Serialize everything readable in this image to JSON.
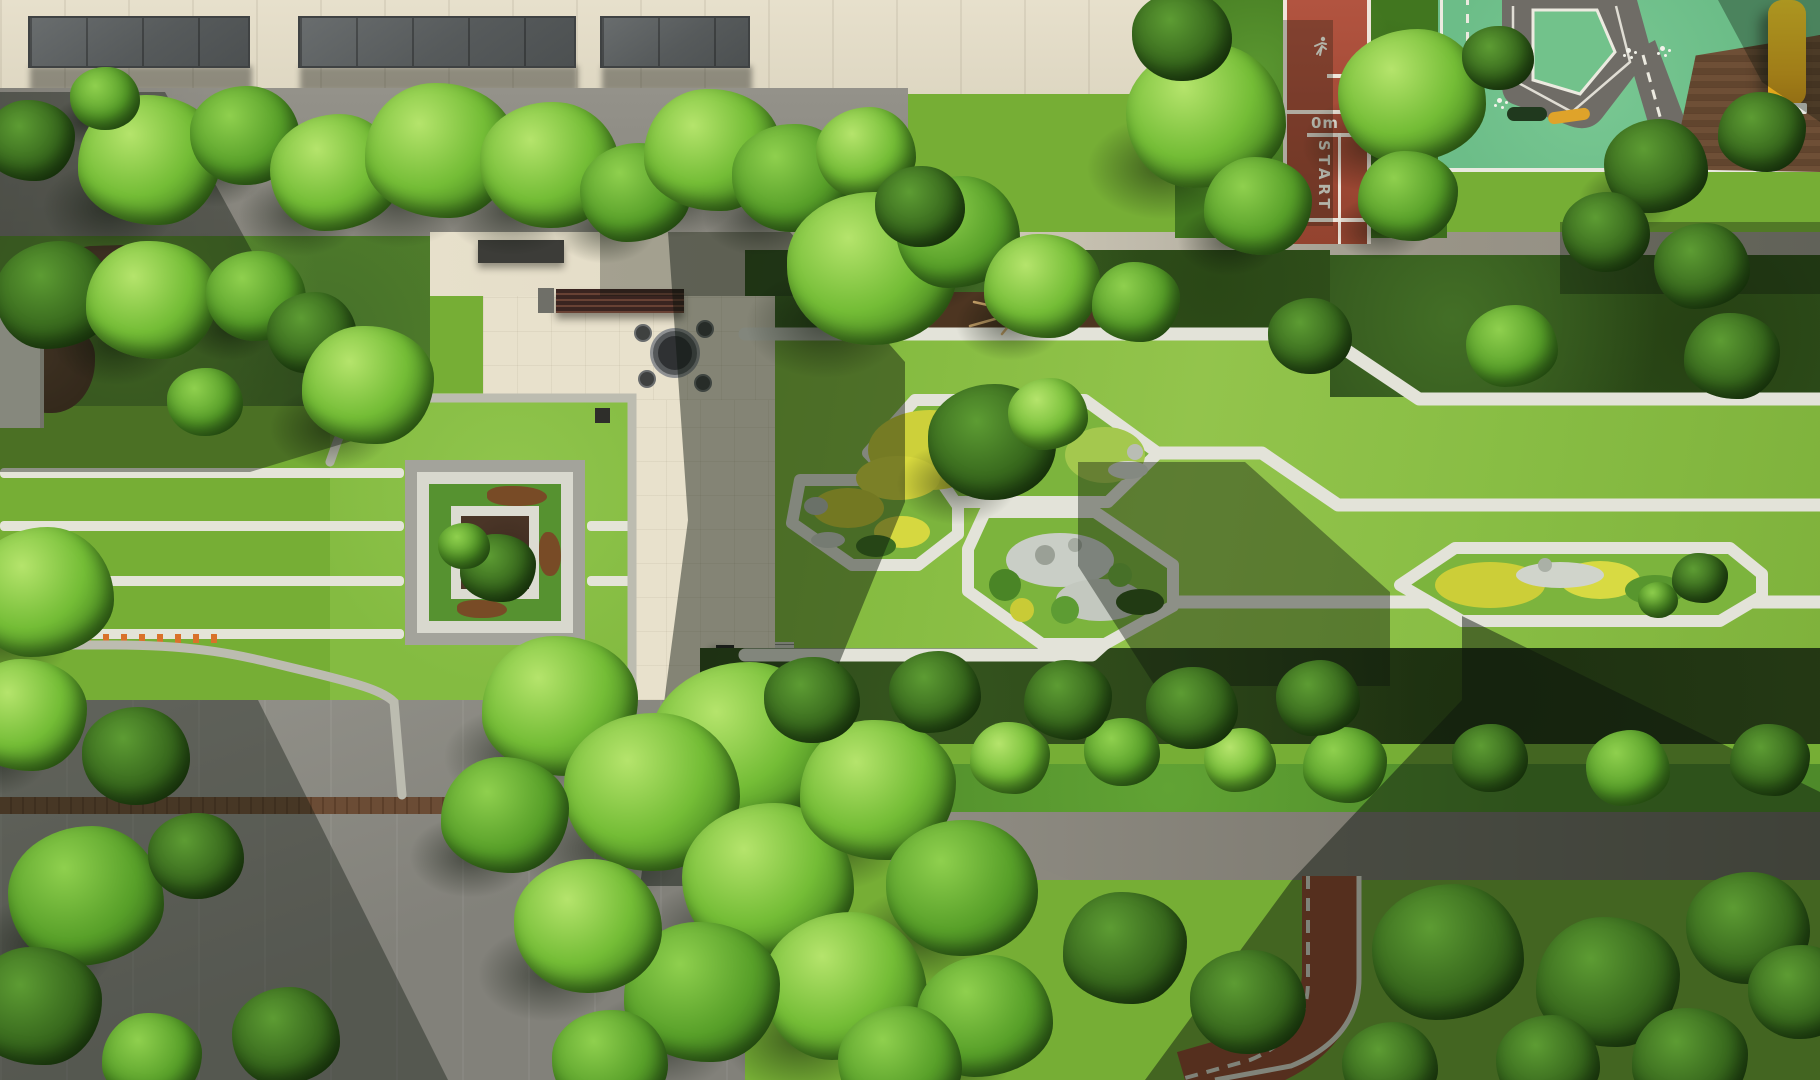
{
  "scene": {
    "description": "Aerial drone photo of a residential landscape: formal concentric garden, geometric lawn paths with planted islands, central plaza with round tables, red running track, children's traffic playground, tree masses and long building shadows.",
    "track": {
      "zero_label": "0m",
      "start_label": "START",
      "surface_color": "#a84b36",
      "line_color": "#f4f1e6"
    },
    "playground": {
      "surface_color": "#6cbd88",
      "road_color": "#6f6c66",
      "deck_color": "#6e4f36",
      "slide_color": "#ffd92b",
      "kid_car_color": "#20391e",
      "trailer_color": "#dfa32a"
    },
    "palette": {
      "lawn": "#7db63a",
      "lawn_bright": "#93c44c",
      "hedge_dark": "#2f4f1b",
      "tree_bright": "#74bd36",
      "tree_dark": "#38691d",
      "paving_cream": "#e7e0cb",
      "paving_gray": "#8f8d85",
      "curb_white": "#e3e3d9",
      "mulch_brown": "#4d3521",
      "yellow_shrub": "#cdd03a",
      "gravel_white": "#cdd1c8",
      "shadow": "#0c150c"
    },
    "icons": {
      "runner": "runner-pictogram-icon",
      "flower_marking": "pavement-flower-marking-icon"
    },
    "islands": [
      {
        "name": "island-a",
        "contents": "yellow shrubs, trees, gravel"
      },
      {
        "name": "island-b",
        "contents": "yellow shrubs, rock, gravel"
      },
      {
        "name": "island-c",
        "contents": "rock garden, gravel, green mounds"
      },
      {
        "name": "island-d",
        "contents": "yellow shrubs, gravel, small trees"
      }
    ],
    "furniture": [
      {
        "name": "round-table",
        "x": 675,
        "y": 353
      },
      {
        "name": "round-table",
        "x": 679,
        "y": 753
      }
    ],
    "trees": [
      [
        150,
        160,
        72,
        0,
        1
      ],
      [
        245,
        135,
        55,
        1,
        1
      ],
      [
        335,
        172,
        65,
        0,
        1
      ],
      [
        440,
        150,
        75,
        0,
        1
      ],
      [
        550,
        165,
        70,
        0,
        1
      ],
      [
        635,
        192,
        55,
        1,
        1
      ],
      [
        712,
        150,
        68,
        0,
        1
      ],
      [
        792,
        178,
        60,
        1,
        1
      ],
      [
        866,
        152,
        50,
        0,
        1
      ],
      [
        30,
        140,
        45,
        2,
        0
      ],
      [
        105,
        98,
        35,
        1,
        1
      ],
      [
        55,
        295,
        60,
        2,
        0
      ],
      [
        152,
        300,
        66,
        0,
        1
      ],
      [
        256,
        296,
        50,
        1,
        1
      ],
      [
        312,
        332,
        45,
        2,
        0
      ],
      [
        368,
        385,
        66,
        0,
        1
      ],
      [
        205,
        402,
        38,
        1,
        0
      ],
      [
        42,
        592,
        72,
        0,
        1
      ],
      [
        25,
        715,
        62,
        0,
        1
      ],
      [
        136,
        756,
        54,
        2,
        0
      ],
      [
        86,
        896,
        78,
        1,
        1
      ],
      [
        36,
        1006,
        66,
        2,
        0
      ],
      [
        196,
        856,
        48,
        2,
        0
      ],
      [
        286,
        1036,
        54,
        2,
        0
      ],
      [
        152,
        1058,
        50,
        1,
        0
      ],
      [
        872,
        268,
        85,
        0,
        1
      ],
      [
        958,
        232,
        62,
        1,
        1
      ],
      [
        1042,
        286,
        58,
        0,
        1
      ],
      [
        920,
        206,
        45,
        2,
        0
      ],
      [
        1206,
        116,
        80,
        0,
        1
      ],
      [
        1258,
        206,
        54,
        1,
        1
      ],
      [
        1182,
        36,
        50,
        2,
        0
      ],
      [
        1412,
        96,
        74,
        0,
        1
      ],
      [
        1408,
        196,
        50,
        1,
        1
      ],
      [
        1498,
        58,
        36,
        2,
        0
      ],
      [
        1656,
        166,
        52,
        2,
        1
      ],
      [
        1762,
        132,
        44,
        2,
        0
      ],
      [
        1606,
        232,
        44,
        2,
        0
      ],
      [
        1702,
        266,
        48,
        2,
        0
      ],
      [
        1136,
        302,
        44,
        1,
        0
      ],
      [
        1310,
        336,
        42,
        2,
        0
      ],
      [
        1512,
        346,
        46,
        1,
        0
      ],
      [
        1732,
        356,
        48,
        2,
        0
      ],
      [
        992,
        442,
        64,
        2,
        1
      ],
      [
        1048,
        414,
        40,
        0,
        0
      ],
      [
        498,
        568,
        38,
        2,
        0
      ],
      [
        464,
        546,
        26,
        1,
        0
      ],
      [
        742,
        745,
        92,
        0,
        1
      ],
      [
        560,
        706,
        78,
        0,
        1
      ],
      [
        652,
        792,
        88,
        0,
        1
      ],
      [
        768,
        880,
        86,
        0,
        1
      ],
      [
        878,
        790,
        78,
        0,
        1
      ],
      [
        962,
        888,
        76,
        1,
        1
      ],
      [
        845,
        986,
        82,
        0,
        1
      ],
      [
        702,
        992,
        78,
        1,
        1
      ],
      [
        588,
        926,
        74,
        0,
        1
      ],
      [
        985,
        1016,
        68,
        1,
        1
      ],
      [
        505,
        815,
        64,
        1,
        1
      ],
      [
        610,
        1062,
        58,
        1,
        0
      ],
      [
        900,
        1062,
        62,
        1,
        0
      ],
      [
        1010,
        758,
        40,
        0,
        0
      ],
      [
        1122,
        752,
        38,
        1,
        0
      ],
      [
        1240,
        760,
        36,
        0,
        0
      ],
      [
        1345,
        765,
        42,
        1,
        0
      ],
      [
        1490,
        758,
        38,
        2,
        0
      ],
      [
        1628,
        768,
        42,
        1,
        0
      ],
      [
        1770,
        760,
        40,
        2,
        0
      ],
      [
        812,
        700,
        48,
        2,
        0
      ],
      [
        935,
        692,
        46,
        2,
        0
      ],
      [
        1068,
        700,
        44,
        2,
        0
      ],
      [
        1192,
        708,
        46,
        2,
        0
      ],
      [
        1318,
        698,
        42,
        2,
        0
      ],
      [
        1125,
        948,
        62,
        2,
        0
      ],
      [
        1248,
        1002,
        58,
        2,
        0
      ],
      [
        1448,
        952,
        76,
        2,
        0
      ],
      [
        1608,
        982,
        72,
        2,
        0
      ],
      [
        1748,
        928,
        62,
        2,
        0
      ],
      [
        1548,
        1062,
        52,
        2,
        0
      ],
      [
        1690,
        1060,
        58,
        2,
        0
      ],
      [
        1800,
        992,
        52,
        2,
        0
      ],
      [
        1390,
        1065,
        48,
        2,
        0
      ],
      [
        1700,
        578,
        28,
        2,
        0
      ],
      [
        1658,
        600,
        20,
        1,
        0
      ]
    ]
  }
}
